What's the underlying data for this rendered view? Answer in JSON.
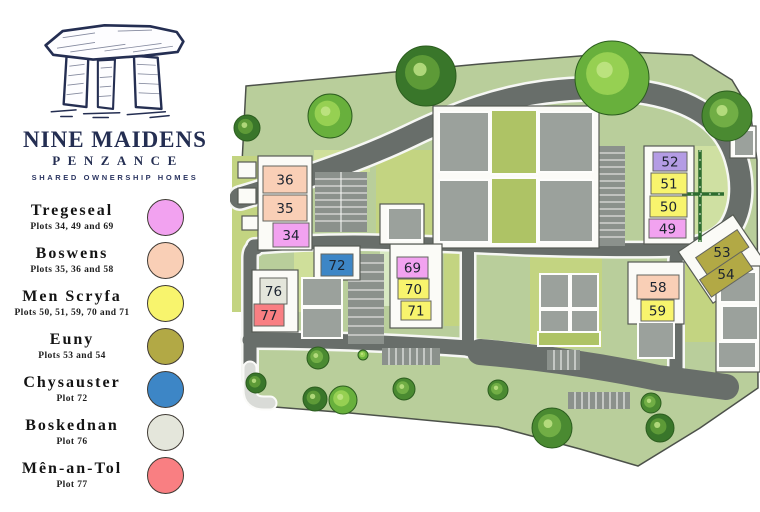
{
  "branding": {
    "title": "NINE MAIDENS",
    "subtitle": "PENZANCE",
    "tagline": "SHARED OWNERSHIP HOMES",
    "logo_icon": "dolmen-standing-stones",
    "navy": "#242e52"
  },
  "palette": {
    "tregeseal": "#f2a2f0",
    "boswens": "#f9cfb6",
    "men_scryfa": "#f8f46d",
    "euny": "#b2a945",
    "chysauster": "#3d86c6",
    "boskednan": "#e4e6db",
    "men_an_tol": "#f97f82",
    "lavender": "#b49ce4",
    "land_green": "#b9ce9b",
    "road_gray": "#686e6a",
    "building_gray": "#9ba19c"
  },
  "legend": {
    "items": [
      {
        "name": "Tregeseal",
        "plots": "Plots 34, 49 and 69",
        "color": "tregeseal"
      },
      {
        "name": "Boswens",
        "plots": "Plots 35, 36 and 58",
        "color": "boswens"
      },
      {
        "name": "Men Scryfa",
        "plots": "Plots 50, 51, 59, 70 and 71",
        "color": "men_scryfa"
      },
      {
        "name": "Euny",
        "plots": "Plots 53 and 54",
        "color": "euny"
      },
      {
        "name": "Chysauster",
        "plots": "Plot 72",
        "color": "chysauster"
      },
      {
        "name": "Boskednan",
        "plots": "Plot 76",
        "color": "boskednan"
      },
      {
        "name": "Mên-an-Tol",
        "plots": "Plot 77",
        "color": "men_an_tol"
      }
    ]
  },
  "map": {
    "plots": [
      {
        "number": "36",
        "color": "boswens",
        "x": 33,
        "y": 166,
        "w": 44,
        "h": 27
      },
      {
        "number": "35",
        "color": "boswens",
        "x": 33,
        "y": 195,
        "w": 44,
        "h": 26
      },
      {
        "number": "34",
        "color": "tregeseal",
        "x": 43,
        "y": 223,
        "w": 36,
        "h": 24
      },
      {
        "number": "52",
        "color": "lavender",
        "x": 423,
        "y": 152,
        "w": 34,
        "h": 19
      },
      {
        "number": "51",
        "color": "men_scryfa",
        "x": 421,
        "y": 173,
        "w": 36,
        "h": 21
      },
      {
        "number": "50",
        "color": "men_scryfa",
        "x": 420,
        "y": 196,
        "w": 37,
        "h": 21
      },
      {
        "number": "49",
        "color": "tregeseal",
        "x": 419,
        "y": 219,
        "w": 37,
        "h": 19
      },
      {
        "number": "53",
        "color": "euny",
        "x": 467,
        "y": 242,
        "w": 50,
        "h": 21,
        "rot": -34,
        "cx": 492,
        "cy": 252
      },
      {
        "number": "54",
        "color": "euny",
        "x": 471,
        "y": 264,
        "w": 50,
        "h": 21,
        "rot": -34,
        "cx": 496,
        "cy": 274
      },
      {
        "number": "69",
        "color": "tregeseal",
        "x": 167,
        "y": 257,
        "w": 31,
        "h": 21
      },
      {
        "number": "70",
        "color": "men_scryfa",
        "x": 168,
        "y": 279,
        "w": 31,
        "h": 20
      },
      {
        "number": "71",
        "color": "men_scryfa",
        "x": 171,
        "y": 301,
        "w": 30,
        "h": 19
      },
      {
        "number": "72",
        "color": "chysauster",
        "x": 91,
        "y": 254,
        "w": 32,
        "h": 22
      },
      {
        "number": "76",
        "color": "boskednan",
        "x": 30,
        "y": 278,
        "w": 27,
        "h": 26
      },
      {
        "number": "77",
        "color": "men_an_tol",
        "x": 24,
        "y": 304,
        "w": 30,
        "h": 22
      },
      {
        "number": "58",
        "color": "boswens",
        "x": 407,
        "y": 275,
        "w": 42,
        "h": 24
      },
      {
        "number": "59",
        "color": "men_scryfa",
        "x": 411,
        "y": 300,
        "w": 33,
        "h": 21
      }
    ]
  }
}
